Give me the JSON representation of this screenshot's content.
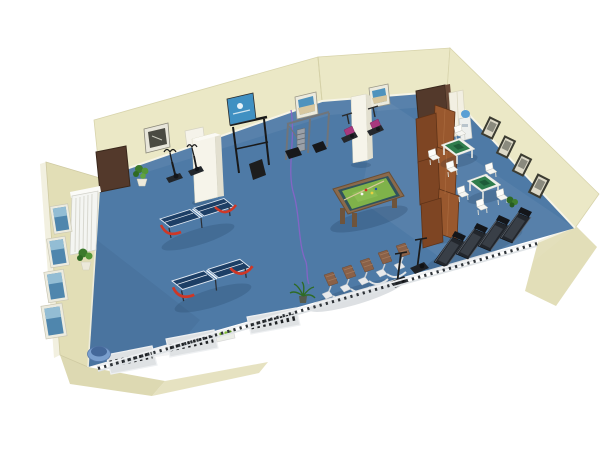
{
  "scene": {
    "name": "recreation-room-3d-floorplan",
    "view": "isometric-3d-render"
  },
  "palette": {
    "background": "#ffffff",
    "wall": "#ebe8c6",
    "wall_shaded": "#e2deb6",
    "wall_exterior": "#ddd9b2",
    "wall_edge": "#cfcaa2",
    "floor": "#4e7aa6",
    "skirting": "#f6f4e6",
    "door": "#53392b",
    "column": "#f6f4ea",
    "radiator": "#f4f5f2",
    "billiard_felt": "#7fb24a",
    "billiard_rail": "#8a6a4c",
    "billiard_border": "#30525c",
    "table_tennis_top": "#1d3f66",
    "table_tennis_support": "#cf3726",
    "mahjong_rim": "#f1f1ec",
    "mahjong_felt": "#2f7d4c",
    "screen_wood_light": "#99582e",
    "screen_wood_dark": "#7e4523",
    "treadmill": "#22262c",
    "rider_pad": "#8a6148",
    "bike_magenta": "#a8387e",
    "chair": "#f6f6f2",
    "railing": "#eef0f2",
    "baluster": "#2e3338",
    "plant": "#3c7a2c",
    "palm": "#2f6b26",
    "cable": "#8a63c9",
    "picture_art_blue": "#4f86ad",
    "picture_frame_dark": "#3c3c32",
    "poster_blue": "#4090c2",
    "water_bottle": "#5a9fd4",
    "bin": "#7a9fce",
    "gym_frame": "#70757b"
  },
  "inventory": {
    "ping_pong_tables": 2,
    "billiard_tables": 1,
    "mahjong_tables": 2,
    "mahjong_chairs": 7,
    "treadmills": 4,
    "rider_machines": 5,
    "exercise_bikes": 4,
    "multi_gym_stations": 1,
    "pull_up_racks": 1,
    "folding_screen_panels": 6,
    "doors": 2,
    "columns": 2,
    "radiators": 1,
    "water_coolers": 1,
    "floor_mats": 3,
    "plants": 4,
    "pictures_left_wall": 4,
    "pictures_top_wall": 3,
    "pictures_right_wall": 4,
    "posters": 1,
    "waste_bins": 1
  }
}
